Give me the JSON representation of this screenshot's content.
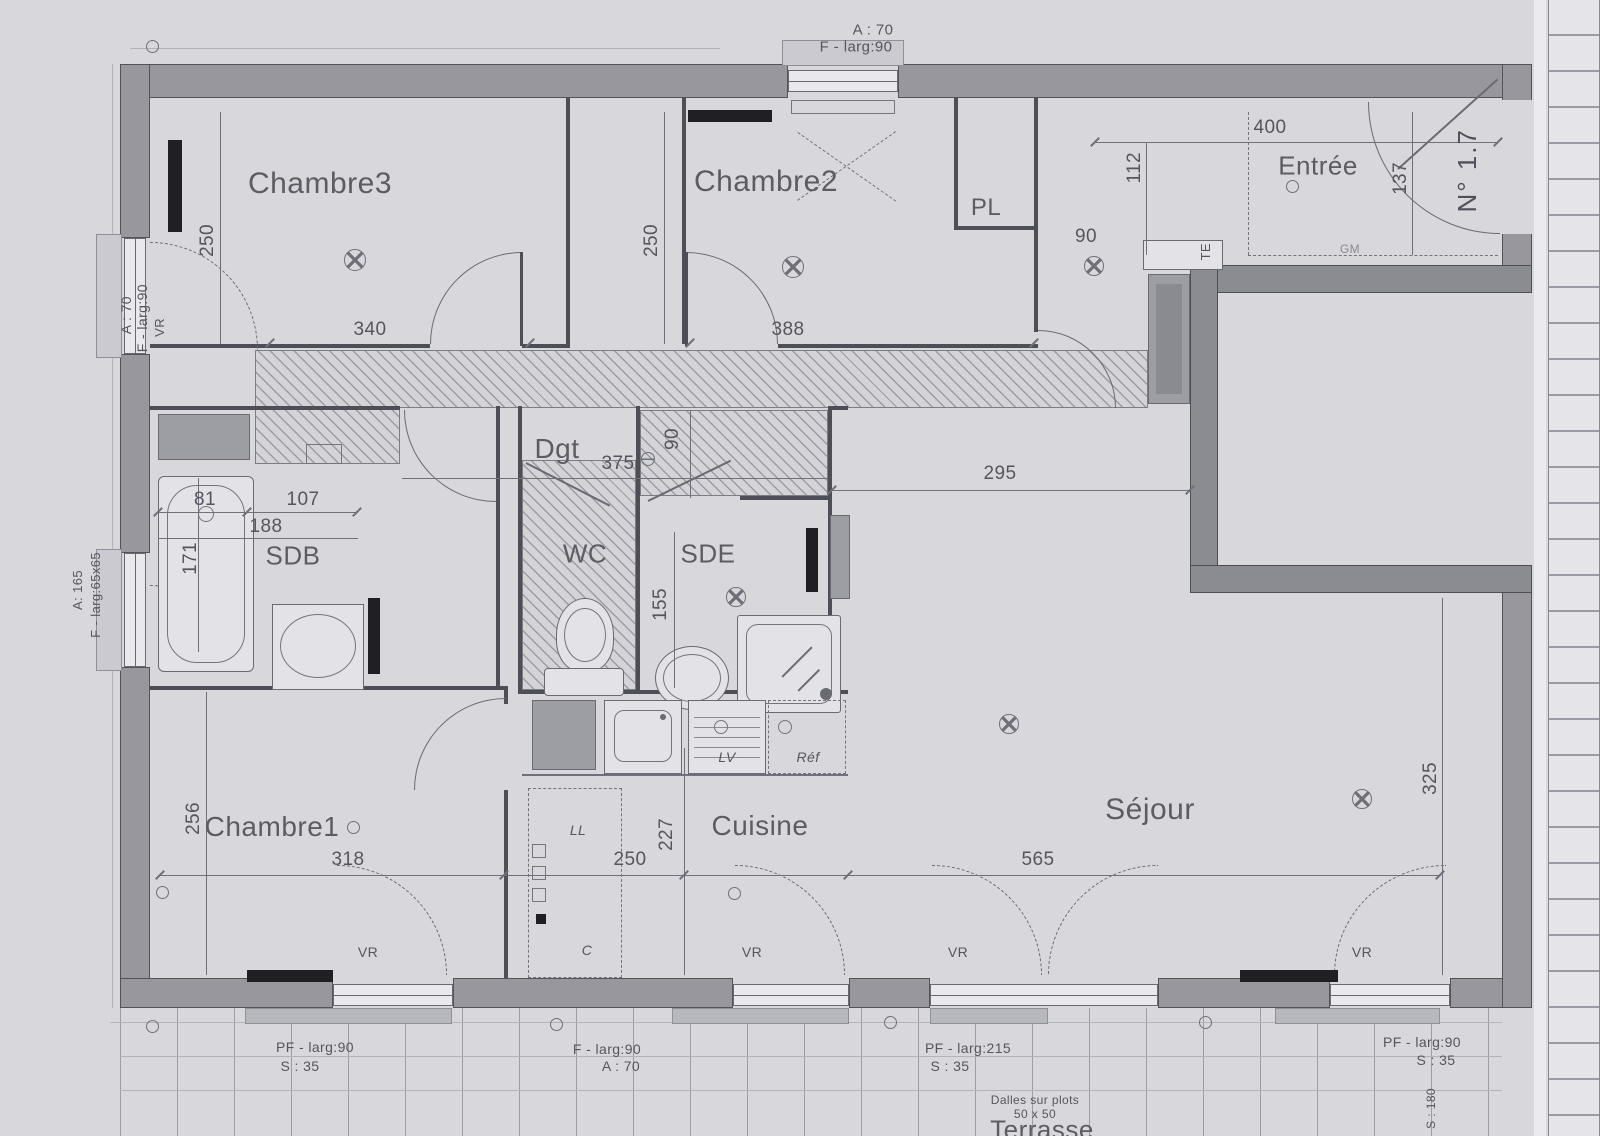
{
  "plan": {
    "rooms": {
      "chambre3": "Chambre3",
      "chambre2": "Chambre2",
      "pl": "PL",
      "entree": "Entrée",
      "dgt": "Dgt",
      "sdb": "SDB",
      "wc": "WC",
      "sde": "SDE",
      "chambre1": "Chambre1",
      "cuisine": "Cuisine",
      "sejour": "Séjour",
      "terrasse": "Terrasse"
    },
    "dims": {
      "c3_h": "250",
      "c3_w": "340",
      "c2_h": "250",
      "c2_w": "388",
      "ent_w": "400",
      "ent_h": "112",
      "ent_door": "137",
      "pl_gap": "90",
      "sdb_a": "81",
      "sdb_b": "107",
      "sdb_w": "188",
      "sdb_h": "171",
      "dgt_l": "375",
      "dgt_w": "90",
      "hall_w": "295",
      "sde_h": "155",
      "c1_h": "256",
      "c1_w": "318",
      "cuis_w": "250",
      "cuis_h": "227",
      "sej_w": "565",
      "sej_h": "325"
    },
    "labels": {
      "door_no": "N° 1.7",
      "te": "TE",
      "gm": "GM",
      "vr": "VR",
      "lv": "LV",
      "refr": "Réf",
      "ll": "LL",
      "c": "C",
      "terr_side": "S : 180"
    },
    "notes": {
      "top_win": {
        "l1": "A : 70",
        "l2": "F - larg:90"
      },
      "left_win_upper": {
        "l1": "A : 70",
        "l2": "F - larg:90"
      },
      "left_win_lower": {
        "l1": "A: 165",
        "l2": "F - larg:65x65"
      },
      "bottom": [
        {
          "l1": "PF - larg:90",
          "l2": "S : 35"
        },
        {
          "l1": "F - larg:90",
          "l2": "A : 70"
        },
        {
          "l1": "PF - larg:215",
          "l2": "S : 35"
        },
        {
          "l1": "PF - larg:90",
          "l2": "S : 35"
        }
      ],
      "terrasse": {
        "note1": "Dalles sur plots",
        "note2": "50 x 50"
      }
    }
  }
}
